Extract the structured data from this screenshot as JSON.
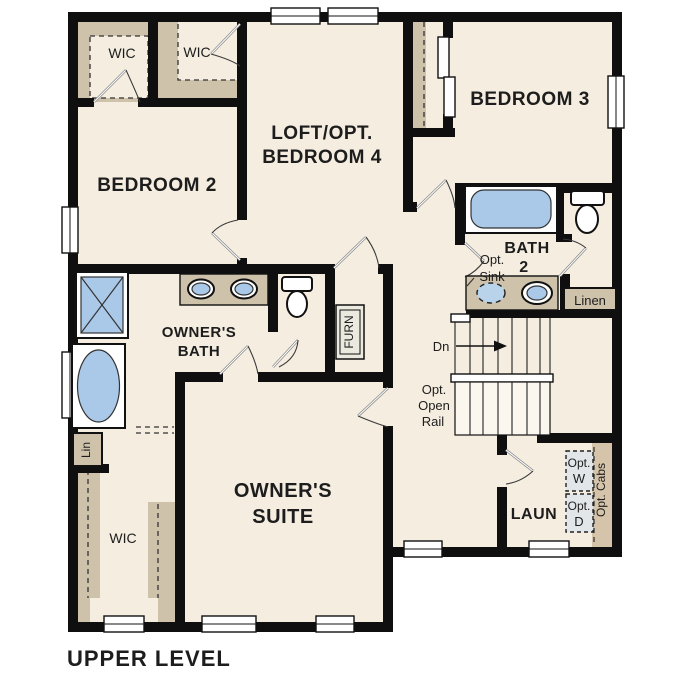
{
  "plan": {
    "title": "UPPER LEVEL",
    "rooms": {
      "wic_top_left": "WIC",
      "wic_top_mid": "WIC",
      "bedroom_2": "BEDROOM 2",
      "loft_line1": "LOFT/OPT.",
      "loft_line2": "BEDROOM 4",
      "bedroom_3": "BEDROOM 3",
      "bath_2_line1": "BATH",
      "bath_2_line2": "2",
      "owners_bath_line1": "OWNER'S",
      "owners_bath_line2": "BATH",
      "owners_suite_line1": "OWNER'S",
      "owners_suite_line2": "SUITE",
      "owners_wic": "WIC",
      "laundry": "LAUN"
    },
    "labels": {
      "opt_sink_line1": "Opt.",
      "opt_sink_line2": "Sink",
      "linen": "Linen",
      "lin_closet": "Lin",
      "furnace": "FURN",
      "stair_down": "Dn",
      "open_rail_line1": "Opt.",
      "open_rail_line2": "Open",
      "open_rail_line3": "Rail",
      "opt_washer_line1": "Opt.",
      "opt_washer_line2": "W",
      "opt_dryer_line1": "Opt.",
      "opt_dryer_line2": "D",
      "opt_cabinets": "Opt. Cabs"
    },
    "colors": {
      "floor": "#f4ede0",
      "closet_shading": "#cec2ab",
      "cabinet_shading": "#d5c4a9",
      "fixture_blue": "#aac9e8",
      "appliance_gray": "#e2e6e8",
      "wall": "#0f0f0f",
      "text": "#1d1d1d",
      "background": "#ffffff"
    }
  }
}
